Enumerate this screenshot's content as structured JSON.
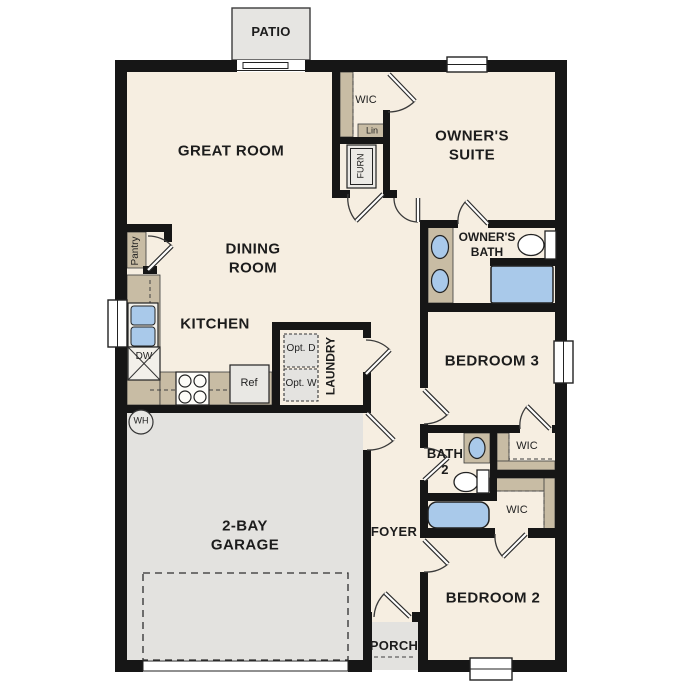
{
  "plan": {
    "title": "single-story residential floor plan",
    "labels": {
      "patio": "PATIO",
      "great_room": "GREAT ROOM",
      "wic_owners": "WIC",
      "lin": "Lin",
      "furn": "FURN",
      "owners_suite": "OWNER'S SUITE",
      "owners_bath": "OWNER'S BATH",
      "dining_room": "DINING ROOM",
      "pantry": "Pantry",
      "kitchen": "KITCHEN",
      "dw": "DW",
      "ref": "Ref",
      "opt_d": "Opt. D",
      "opt_w": "Opt. W",
      "laundry": "LAUNDRY",
      "bedroom3": "BEDROOM 3",
      "wh": "WH",
      "garage": "2-BAY GARAGE",
      "foyer": "FOYER",
      "bath2": "BATH 2",
      "wic_bedroom3": "WIC",
      "wic_bedroom2": "WIC",
      "porch": "PORCH",
      "bedroom2": "BEDROOM 2"
    },
    "colors": {
      "wall": "#161616",
      "floor": "#f6eee1",
      "hard_surface": "#e3e2df",
      "casework_tan": "#c8bca4",
      "fixture_blue": "#a9c9ea",
      "appliance_gray": "#e9e8e4"
    }
  }
}
